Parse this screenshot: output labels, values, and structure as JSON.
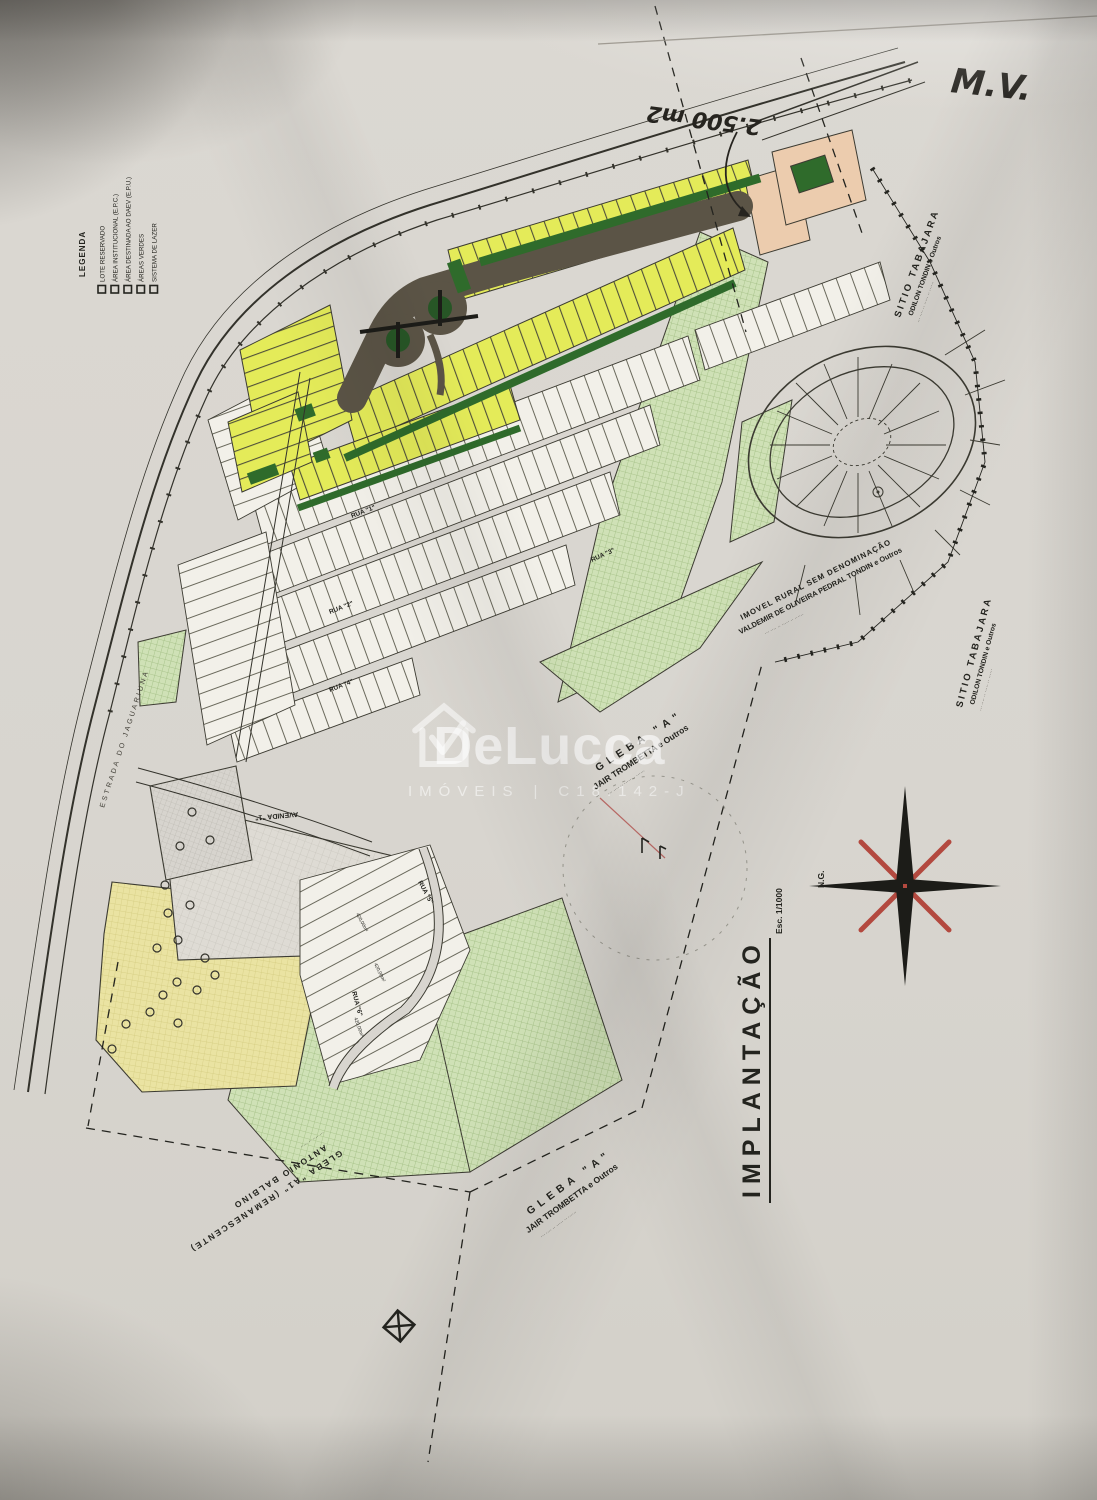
{
  "handwriting": {
    "initials": "M.V.",
    "area_note": "2.500 m2"
  },
  "legend": {
    "title": "LEGENDA",
    "items": [
      {
        "label": "LOTE RESERVADO"
      },
      {
        "label": "ÁREA INSTITUCIONAL (E.P.C.)"
      },
      {
        "label": "ÁREA DESTINADA AO DAEV (E.P.U.)"
      },
      {
        "label": "ÁREAS VERDES"
      },
      {
        "label": "SISTEMA DE LAZER"
      }
    ]
  },
  "plan": {
    "title": "IMPLANTAÇÃO",
    "scale": "Esc. 1/1000",
    "north_label": "N.G.",
    "roads": {
      "estrada": "ESTRADA DO JAGUARIUNA",
      "avenida": "AVENIDA \"1\"",
      "rua1": "RUA \"1\"",
      "rua2": "RUA \"2\"",
      "rua3": "RUA \"3\"",
      "rua4": "RUA \"4\"",
      "rua5": "RUA \"5\"",
      "rua6": "RUA \"6\""
    },
    "neighbors": {
      "sitio_top": {
        "name": "SITIO TABAJARA",
        "owner": "ODILON TONDIN e Outros",
        "microtext": "··· ···· ·· ····· ·· ······"
      },
      "sitio_right": {
        "name": "SITIO TABAJARA",
        "owner": "ODILON TONDIN e Outros",
        "microtext": "··· ···· ·· ····· ·· ······"
      },
      "imovel_rural": {
        "line1": "IMOVEL RURAL SEM DENOMINAÇÃO",
        "line2": "VALDEMIR DE OLIVEIRA PEDRAL TONDIN e Outros",
        "microtext": "··· ···· ·· ····· ·· ······"
      },
      "gleba_center": {
        "line1": "GLEBA  \"A\"",
        "line2": "JAIR TROMBETTA e Outros",
        "microtext": "··· ···· ·· ····· ·· ······"
      },
      "gleba_bottom": {
        "line1": "GLEBA  \"A\"",
        "line2": "JAIR TROMBETTA e Outros",
        "microtext": "··· ···· ·· ····· ·· ······"
      },
      "gleba_remanescente": {
        "line1": "GLEBA \"A1\" (REMANESCENTE)",
        "line2": "ANTONIO BALBINO",
        "microtext": "··· ···· ·· ·····"
      }
    },
    "lot_area_labels": [
      "420,00m²",
      "420,00m²",
      "420,00m²"
    ]
  },
  "watermark": {
    "brand": "DeLucca",
    "line": "IMÓVEIS",
    "separator": "|",
    "registry": "C18.142-J"
  },
  "colors": {
    "paper": "#d8d5cf",
    "ink": "#24241f",
    "lot_yellow": "#e4eb59",
    "green_dark": "#2f6b2b",
    "green_light": "#cfe1b6",
    "salmon": "#ecccae",
    "road_dark": "#5b5446",
    "compass_red": "#b3493f",
    "watermark_white": "rgba(255,255,255,0.6)"
  }
}
